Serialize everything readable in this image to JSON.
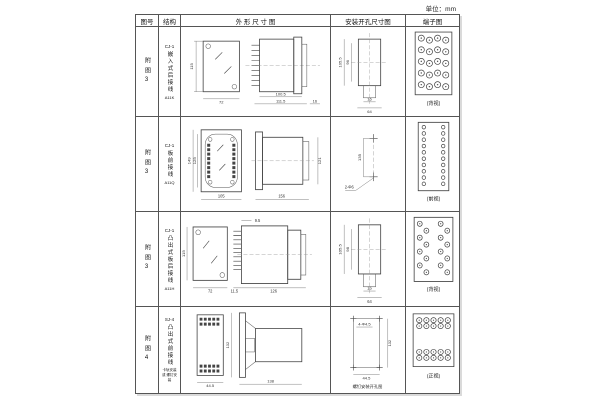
{
  "unit_label": "单位：mm",
  "header": {
    "fig_no": "图号",
    "structure": "结构",
    "outline": "外 形 尺 寸 图",
    "mounting": "安装开孔尺寸图",
    "terminal": "端子图"
  },
  "rows": [
    {
      "fig_no": "附图3",
      "model": "CJ-1",
      "name": "嵌入式后接线",
      "code": "A11K",
      "outline": {
        "front_h": "115",
        "front_w": "72",
        "d1": "100.5",
        "d2": "111.5",
        "d3": "16"
      },
      "mounting": {
        "v1": "105.5",
        "v2": "96",
        "b1": "16",
        "b2": "64"
      },
      "terminal_caption": "(背视)"
    },
    {
      "fig_no": "附图3",
      "model": "CJ-1",
      "name": "板前接线",
      "code": "A11Q",
      "outline": {
        "h1": "149",
        "h2": "125",
        "w": "105",
        "side_w": "156",
        "side_h": "121"
      },
      "mounting": {
        "v": "135",
        "holes": "2-Φ6"
      },
      "terminal_caption": "(前视)"
    },
    {
      "fig_no": "附图3",
      "model": "CJ-1",
      "name": "凸出式板后接线",
      "code": "A11H",
      "outline": {
        "front_h": "115",
        "front_w": "72",
        "top": "9.5",
        "pin": "11.5",
        "side_w": "126"
      },
      "mounting": {
        "v1": "105.5",
        "v2": "98",
        "b1": "16",
        "b2": "64"
      },
      "terminal_caption": "(背视)"
    },
    {
      "fig_no": "附图4",
      "model": "SJ-4",
      "name": "凸出式前接线",
      "note": "卡轨安装 或 螺钉安装",
      "outline": {
        "front_w": "44.5",
        "side_h": "132",
        "side_w": "138"
      },
      "mounting": {
        "holes": "4-Φ4.5",
        "v": "132",
        "b": "44.5",
        "caption": "螺钉安装开孔图"
      },
      "terminal_caption": "(正视)"
    }
  ]
}
